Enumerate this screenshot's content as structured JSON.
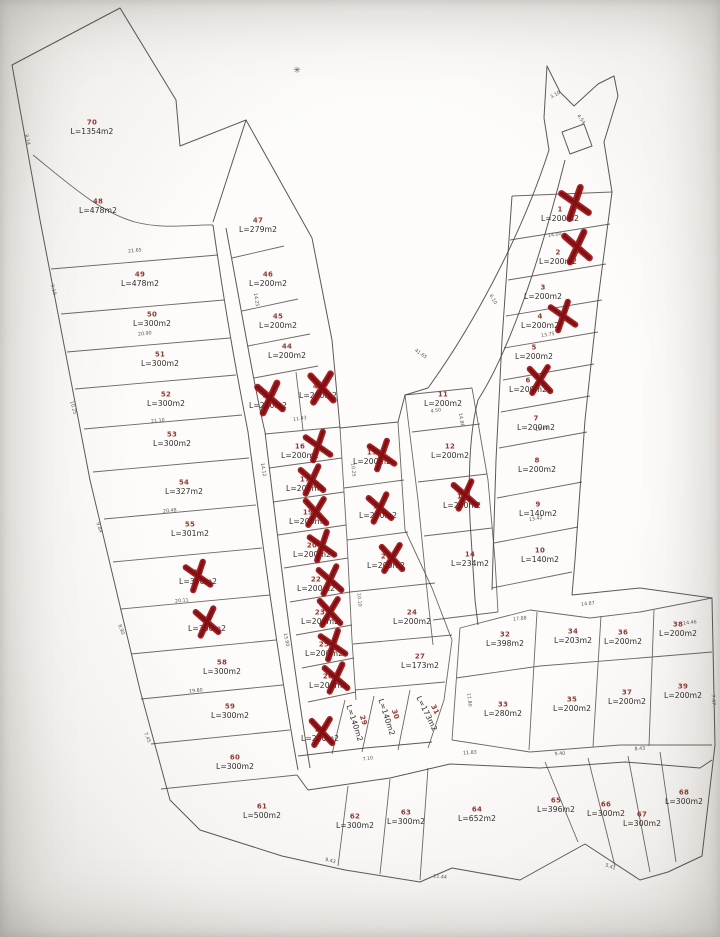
{
  "map": {
    "kind": "land-subdivision-cadastral-plan",
    "line_color": "#46423e",
    "plot_number_color": "#8e3a33",
    "area_text_color": "#2f2c29",
    "sold_cross_color": "#9c1013",
    "background_color": "#fdfcfb"
  },
  "plots": [
    {
      "n": "70",
      "area": "L=1354m2",
      "x": 92,
      "y": 128,
      "crossed": false
    },
    {
      "n": "48",
      "area": "L=478m2",
      "x": 98,
      "y": 207,
      "crossed": false
    },
    {
      "n": "49",
      "area": "L=478m2",
      "x": 140,
      "y": 280,
      "crossed": false
    },
    {
      "n": "50",
      "area": "L=300m2",
      "x": 152,
      "y": 320,
      "crossed": false
    },
    {
      "n": "51",
      "area": "L=300m2",
      "x": 160,
      "y": 360,
      "crossed": false
    },
    {
      "n": "52",
      "area": "L=300m2",
      "x": 166,
      "y": 400,
      "crossed": false
    },
    {
      "n": "53",
      "area": "L=300m2",
      "x": 172,
      "y": 440,
      "crossed": false
    },
    {
      "n": "54",
      "area": "L=327m2",
      "x": 184,
      "y": 488,
      "crossed": false
    },
    {
      "n": "55",
      "area": "L=301m2",
      "x": 190,
      "y": 530,
      "crossed": false
    },
    {
      "n": "56",
      "area": "L=300m2",
      "x": 198,
      "y": 578,
      "crossed": true,
      "cx": 198,
      "cy": 576
    },
    {
      "n": "57",
      "area": "L=300m2",
      "x": 207,
      "y": 625,
      "crossed": true,
      "cx": 207,
      "cy": 622
    },
    {
      "n": "58",
      "area": "L=300m2",
      "x": 222,
      "y": 668,
      "crossed": false
    },
    {
      "n": "59",
      "area": "L=300m2",
      "x": 230,
      "y": 712,
      "crossed": false
    },
    {
      "n": "60",
      "area": "L=300m2",
      "x": 235,
      "y": 763,
      "crossed": false
    },
    {
      "n": "61",
      "area": "L=500m2",
      "x": 262,
      "y": 812,
      "crossed": false
    },
    {
      "n": "47",
      "area": "L=279m2",
      "x": 258,
      "y": 226,
      "crossed": false
    },
    {
      "n": "46",
      "area": "L=200m2",
      "x": 268,
      "y": 280,
      "crossed": false
    },
    {
      "n": "45",
      "area": "L=200m2",
      "x": 278,
      "y": 322,
      "crossed": false
    },
    {
      "n": "44",
      "area": "L=200m2",
      "x": 287,
      "y": 352,
      "crossed": false
    },
    {
      "n": "43",
      "area": "L=200m2",
      "x": 268,
      "y": 402,
      "crossed": true,
      "cx": 270,
      "cy": 398,
      "s": 1.1
    },
    {
      "n": "42",
      "area": "L=200m2",
      "x": 318,
      "y": 392,
      "crossed": true,
      "cx": 322,
      "cy": 388,
      "s": 1.1
    },
    {
      "n": "16",
      "area": "L=200m2",
      "x": 300,
      "y": 452,
      "crossed": true,
      "cx": 318,
      "cy": 446
    },
    {
      "n": "17",
      "area": "L=200m2",
      "x": 305,
      "y": 485,
      "crossed": true,
      "cx": 312,
      "cy": 480
    },
    {
      "n": "19",
      "area": "L=200m2",
      "x": 308,
      "y": 518,
      "crossed": true,
      "cx": 316,
      "cy": 512
    },
    {
      "n": "20",
      "area": "L=200m2",
      "x": 312,
      "y": 551,
      "crossed": true,
      "cx": 322,
      "cy": 546
    },
    {
      "n": "22",
      "area": "L=200m2",
      "x": 316,
      "y": 585,
      "crossed": true,
      "cx": 330,
      "cy": 580
    },
    {
      "n": "23",
      "area": "L=200m2",
      "x": 320,
      "y": 618,
      "crossed": true,
      "cx": 330,
      "cy": 612
    },
    {
      "n": "25",
      "area": "L=200m2",
      "x": 324,
      "y": 650,
      "crossed": true,
      "cx": 333,
      "cy": 645
    },
    {
      "n": "26",
      "area": "L=200m2",
      "x": 328,
      "y": 682,
      "crossed": true,
      "cx": 336,
      "cy": 678
    },
    {
      "n": "28",
      "area": "L=200m2",
      "x": 320,
      "y": 735,
      "crossed": true,
      "cx": 322,
      "cy": 732
    },
    {
      "n": "15",
      "area": "L=200m2",
      "x": 372,
      "y": 458,
      "crossed": true,
      "cx": 382,
      "cy": 455
    },
    {
      "n": "18",
      "area": "L=200m2",
      "x": 378,
      "y": 512,
      "crossed": true,
      "cx": 380,
      "cy": 508
    },
    {
      "n": "21",
      "area": "L=200m2",
      "x": 386,
      "y": 562,
      "crossed": true,
      "cx": 392,
      "cy": 558
    },
    {
      "n": "24",
      "area": "L=200m2",
      "x": 412,
      "y": 618,
      "crossed": false
    },
    {
      "n": "27",
      "area": "L=173m2",
      "x": 420,
      "y": 662,
      "crossed": false
    },
    {
      "n": "29",
      "area": "L=140m2",
      "x": 358,
      "y": 722,
      "crossed": false,
      "rot": 72
    },
    {
      "n": "30",
      "area": "L=140m2",
      "x": 390,
      "y": 716,
      "crossed": false,
      "rot": 72
    },
    {
      "n": "31",
      "area": "L=173m2",
      "x": 430,
      "y": 712,
      "crossed": false,
      "rot": 64
    },
    {
      "n": "11",
      "area": "L=200m2",
      "x": 443,
      "y": 400,
      "crossed": false
    },
    {
      "n": "12",
      "area": "L=200m2",
      "x": 450,
      "y": 452,
      "crossed": false
    },
    {
      "n": "13",
      "area": "L=200m2",
      "x": 462,
      "y": 502,
      "crossed": true,
      "cx": 465,
      "cy": 495
    },
    {
      "n": "14",
      "area": "L=234m2",
      "x": 470,
      "y": 560,
      "crossed": false
    },
    {
      "n": "1",
      "area": "L=200m2",
      "x": 560,
      "y": 215,
      "crossed": true,
      "cx": 575,
      "cy": 203,
      "s": 1.1
    },
    {
      "n": "2",
      "area": "L=200m2",
      "x": 558,
      "y": 258,
      "crossed": true,
      "cx": 577,
      "cy": 247,
      "s": 1.1
    },
    {
      "n": "3",
      "area": "L=200m2",
      "x": 543,
      "y": 293,
      "crossed": false
    },
    {
      "n": "4",
      "area": "L=200m2",
      "x": 540,
      "y": 322,
      "crossed": true,
      "cx": 563,
      "cy": 316
    },
    {
      "n": "5",
      "area": "L=200m2",
      "x": 534,
      "y": 353,
      "crossed": false
    },
    {
      "n": "6",
      "area": "L=200m2",
      "x": 528,
      "y": 386,
      "crossed": true,
      "cx": 540,
      "cy": 380
    },
    {
      "n": "7",
      "area": "L=200m2",
      "x": 536,
      "y": 424,
      "crossed": false
    },
    {
      "n": "8",
      "area": "L=200m2",
      "x": 537,
      "y": 466,
      "crossed": false
    },
    {
      "n": "9",
      "area": "L=140m2",
      "x": 538,
      "y": 510,
      "crossed": false
    },
    {
      "n": "10",
      "area": "L=140m2",
      "x": 540,
      "y": 556,
      "crossed": false
    },
    {
      "n": "32",
      "area": "L=398m2",
      "x": 505,
      "y": 640,
      "crossed": false
    },
    {
      "n": "34",
      "area": "L=203m2",
      "x": 573,
      "y": 637,
      "crossed": false
    },
    {
      "n": "36",
      "area": "L=200m2",
      "x": 623,
      "y": 638,
      "crossed": false
    },
    {
      "n": "38",
      "area": "L=200m2",
      "x": 678,
      "y": 630,
      "crossed": false
    },
    {
      "n": "33",
      "area": "L=280m2",
      "x": 503,
      "y": 710,
      "crossed": false
    },
    {
      "n": "35",
      "area": "L=200m2",
      "x": 572,
      "y": 705,
      "crossed": false
    },
    {
      "n": "37",
      "area": "L=200m2",
      "x": 627,
      "y": 698,
      "crossed": false
    },
    {
      "n": "39",
      "area": "L=200m2",
      "x": 683,
      "y": 692,
      "crossed": false
    },
    {
      "n": "62",
      "area": "L=300m2",
      "x": 355,
      "y": 822,
      "crossed": false
    },
    {
      "n": "63",
      "area": "L=300m2",
      "x": 406,
      "y": 818,
      "crossed": false
    },
    {
      "n": "64",
      "area": "L=652m2",
      "x": 477,
      "y": 815,
      "crossed": false
    },
    {
      "n": "65",
      "area": "L=396m2",
      "x": 556,
      "y": 806,
      "crossed": false
    },
    {
      "n": "66",
      "area": "L=300m2",
      "x": 606,
      "y": 810,
      "crossed": false
    },
    {
      "n": "67",
      "area": "L=300m2",
      "x": 642,
      "y": 820,
      "crossed": false
    },
    {
      "n": "68",
      "area": "L=300m2",
      "x": 684,
      "y": 798,
      "crossed": false
    }
  ],
  "dimension_marks": [
    {
      "t": "8.14",
      "x": 26,
      "y": 140,
      "r": 75
    },
    {
      "t": "9.10",
      "x": 52,
      "y": 290,
      "r": 75
    },
    {
      "t": "10.25",
      "x": 72,
      "y": 408,
      "r": 74
    },
    {
      "t": "9.84",
      "x": 98,
      "y": 528,
      "r": 72
    },
    {
      "t": "8.90",
      "x": 120,
      "y": 630,
      "r": 70
    },
    {
      "t": "7.45",
      "x": 146,
      "y": 738,
      "r": 68
    },
    {
      "t": "21.65",
      "x": 135,
      "y": 252,
      "r": -5
    },
    {
      "t": "20.90",
      "x": 145,
      "y": 335,
      "r": -6
    },
    {
      "t": "21.10",
      "x": 158,
      "y": 422,
      "r": -6
    },
    {
      "t": "20.48",
      "x": 170,
      "y": 512,
      "r": -6
    },
    {
      "t": "20.11",
      "x": 182,
      "y": 602,
      "r": -6
    },
    {
      "t": "19.80",
      "x": 196,
      "y": 692,
      "r": -5
    },
    {
      "t": "14.25",
      "x": 255,
      "y": 300,
      "r": 80
    },
    {
      "t": "14.12",
      "x": 262,
      "y": 470,
      "r": 80
    },
    {
      "t": "13.90",
      "x": 285,
      "y": 640,
      "r": 78
    },
    {
      "t": "11.43",
      "x": 300,
      "y": 420,
      "r": -8
    },
    {
      "t": "10.25",
      "x": 352,
      "y": 470,
      "r": 85
    },
    {
      "t": "10.10",
      "x": 358,
      "y": 600,
      "r": 85
    },
    {
      "t": "41.65",
      "x": 420,
      "y": 355,
      "r": 35
    },
    {
      "t": "4.50",
      "x": 436,
      "y": 412,
      "r": -8
    },
    {
      "t": "14.86",
      "x": 460,
      "y": 420,
      "r": 80
    },
    {
      "t": "6.10",
      "x": 492,
      "y": 300,
      "r": 60
    },
    {
      "t": "14.00",
      "x": 555,
      "y": 236,
      "r": -9
    },
    {
      "t": "13.75",
      "x": 548,
      "y": 336,
      "r": -9
    },
    {
      "t": "13.60",
      "x": 542,
      "y": 430,
      "r": -9
    },
    {
      "t": "13.42",
      "x": 536,
      "y": 520,
      "r": -9
    },
    {
      "t": "4.54",
      "x": 580,
      "y": 120,
      "r": 55
    },
    {
      "t": "3.10",
      "x": 556,
      "y": 96,
      "r": -30
    },
    {
      "t": "17.88",
      "x": 520,
      "y": 620,
      "r": -6
    },
    {
      "t": "14.87",
      "x": 588,
      "y": 605,
      "r": -6
    },
    {
      "t": "11.80",
      "x": 468,
      "y": 700,
      "r": 85
    },
    {
      "t": "14.46",
      "x": 690,
      "y": 624,
      "r": -6
    },
    {
      "t": "7.47",
      "x": 712,
      "y": 700,
      "r": 85
    },
    {
      "t": "11.83",
      "x": 470,
      "y": 754,
      "r": -4
    },
    {
      "t": "9.40",
      "x": 560,
      "y": 755,
      "r": -4
    },
    {
      "t": "8.43",
      "x": 640,
      "y": 750,
      "r": -4
    },
    {
      "t": "7.10",
      "x": 368,
      "y": 760,
      "r": -8
    },
    {
      "t": "5.41",
      "x": 610,
      "y": 868,
      "r": 20
    },
    {
      "t": "9.43",
      "x": 330,
      "y": 862,
      "r": 15
    },
    {
      "t": "11.44",
      "x": 440,
      "y": 878,
      "r": 5
    }
  ],
  "decorations": {
    "asterisk": {
      "glyph": "✳",
      "x": 297,
      "y": 73
    }
  }
}
